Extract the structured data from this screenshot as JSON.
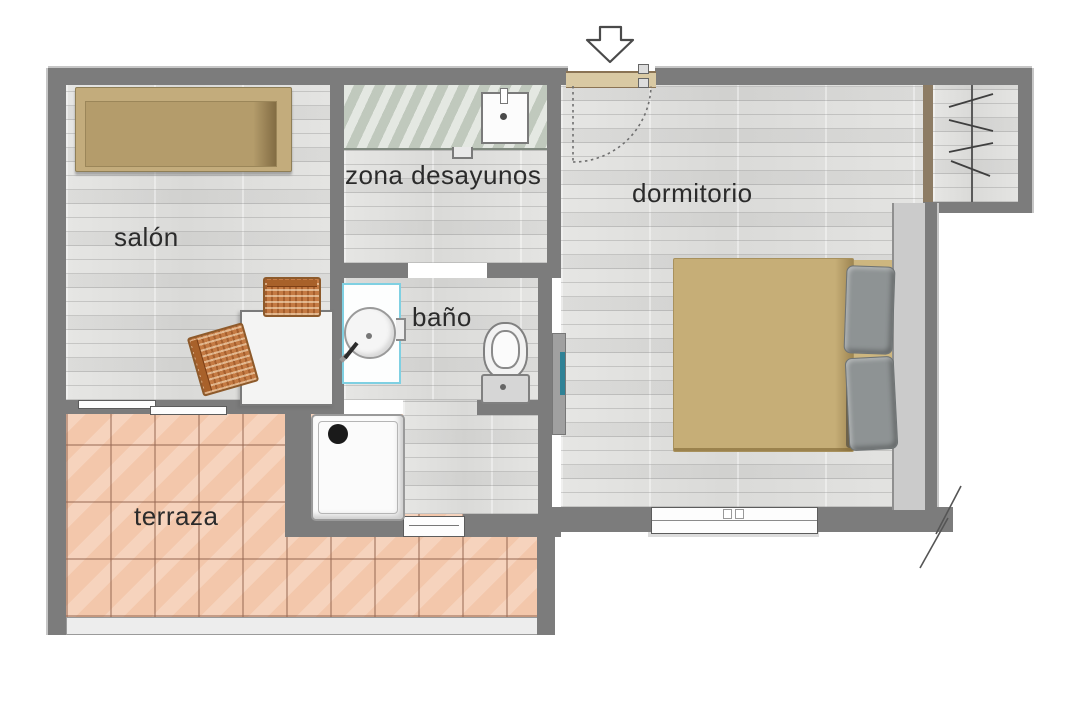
{
  "plan_title": "apartment floor plan",
  "rooms": {
    "salon": {
      "label": "salón"
    },
    "breakfast": {
      "label": "zona desayunos"
    },
    "bedroom": {
      "label": "dormitorio"
    },
    "bathroom": {
      "label": "baño"
    },
    "terrace": {
      "label": "terraza"
    }
  },
  "icons": {
    "entry_arrow": "down-arrow-entrance",
    "door_swing": "door-swing-arc",
    "closet_rails": "clothes-rail-marks",
    "wall_break": "wall-break-marks",
    "shower_drain": "drain-dot"
  },
  "colors": {
    "wall": "#7c7c7c",
    "wall_edge": "#c6c6c6",
    "wood": "#e2e2e0",
    "tile": "#f3c7ab",
    "counter": "#ced6cb",
    "sofa": "#c3ac7c",
    "sofa_seat": "#b49c6b",
    "bed": "#c6ae77",
    "bed_head": "#cdb67f",
    "pillow": "#8e9394",
    "chair": "#c47a43",
    "table": "#f4f4f3",
    "basin_accent": "#7fd0e2",
    "cabinet_accent": "#2f8296",
    "threshold": "#d9c9a3",
    "closet_divider": "#8d7c64",
    "fixture": "#f4f4f4",
    "drain": "#1a1a1a",
    "railing": "#ededed",
    "wardrobe_strip": "#cbcbcb"
  }
}
